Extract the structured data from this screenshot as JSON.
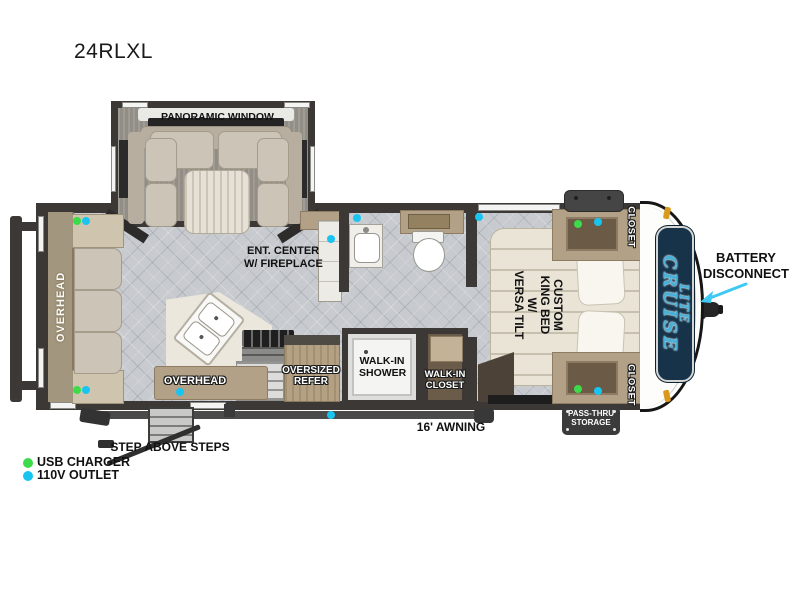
{
  "title": "24RLXL",
  "labels": {
    "panoramic_window": "PANORAMIC WINDOW",
    "ent_center_1": "ENT. CENTER",
    "ent_center_2": "W/ FIREPLACE",
    "overhead_rear": "OVERHEAD",
    "overhead_kitchen": "OVERHEAD",
    "refer_1": "OVERSIZED",
    "refer_2": "REFER",
    "shower_1": "WALK-IN",
    "shower_2": "SHOWER",
    "wcloset_1": "WALK-IN",
    "wcloset_2": "CLOSET",
    "bed_1": "CUSTOM",
    "bed_2": "KING BED W/",
    "bed_3": "VERSA TILT",
    "closet_top": "CLOSET",
    "closet_bottom": "CLOSET",
    "pass_thru_1": "PASS-THRU",
    "pass_thru_2": "STORAGE",
    "awning": "16' AWNING",
    "steps": "STEP ABOVE STEPS",
    "battery_1": "BATTERY",
    "battery_2": "DISCONNECT"
  },
  "logo": {
    "brand_top": "CRUISE",
    "brand_bottom": "LITE",
    "bg_color": "#16334a",
    "text_color": "#49b0d8"
  },
  "legend": {
    "usb": {
      "label": "USB CHARGER",
      "color": "#3ddb4a"
    },
    "outlet110": {
      "label": "110V OUTLET",
      "color": "#1ac4f0"
    }
  },
  "arrow_color": "#3fc8f3",
  "outlets": [
    {
      "type": "usb",
      "x": 77,
      "y": 221
    },
    {
      "type": "outlet110",
      "x": 86,
      "y": 221
    },
    {
      "type": "usb",
      "x": 77,
      "y": 390
    },
    {
      "type": "outlet110",
      "x": 86,
      "y": 390
    },
    {
      "type": "outlet110",
      "x": 180,
      "y": 392
    },
    {
      "type": "outlet110",
      "x": 331,
      "y": 239
    },
    {
      "type": "outlet110",
      "x": 357,
      "y": 218
    },
    {
      "type": "outlet110",
      "x": 331,
      "y": 415
    },
    {
      "type": "outlet110",
      "x": 479,
      "y": 217
    },
    {
      "type": "usb",
      "x": 578,
      "y": 224
    },
    {
      "type": "outlet110",
      "x": 598,
      "y": 222
    },
    {
      "type": "usb",
      "x": 578,
      "y": 389
    },
    {
      "type": "outlet110",
      "x": 598,
      "y": 391
    }
  ]
}
